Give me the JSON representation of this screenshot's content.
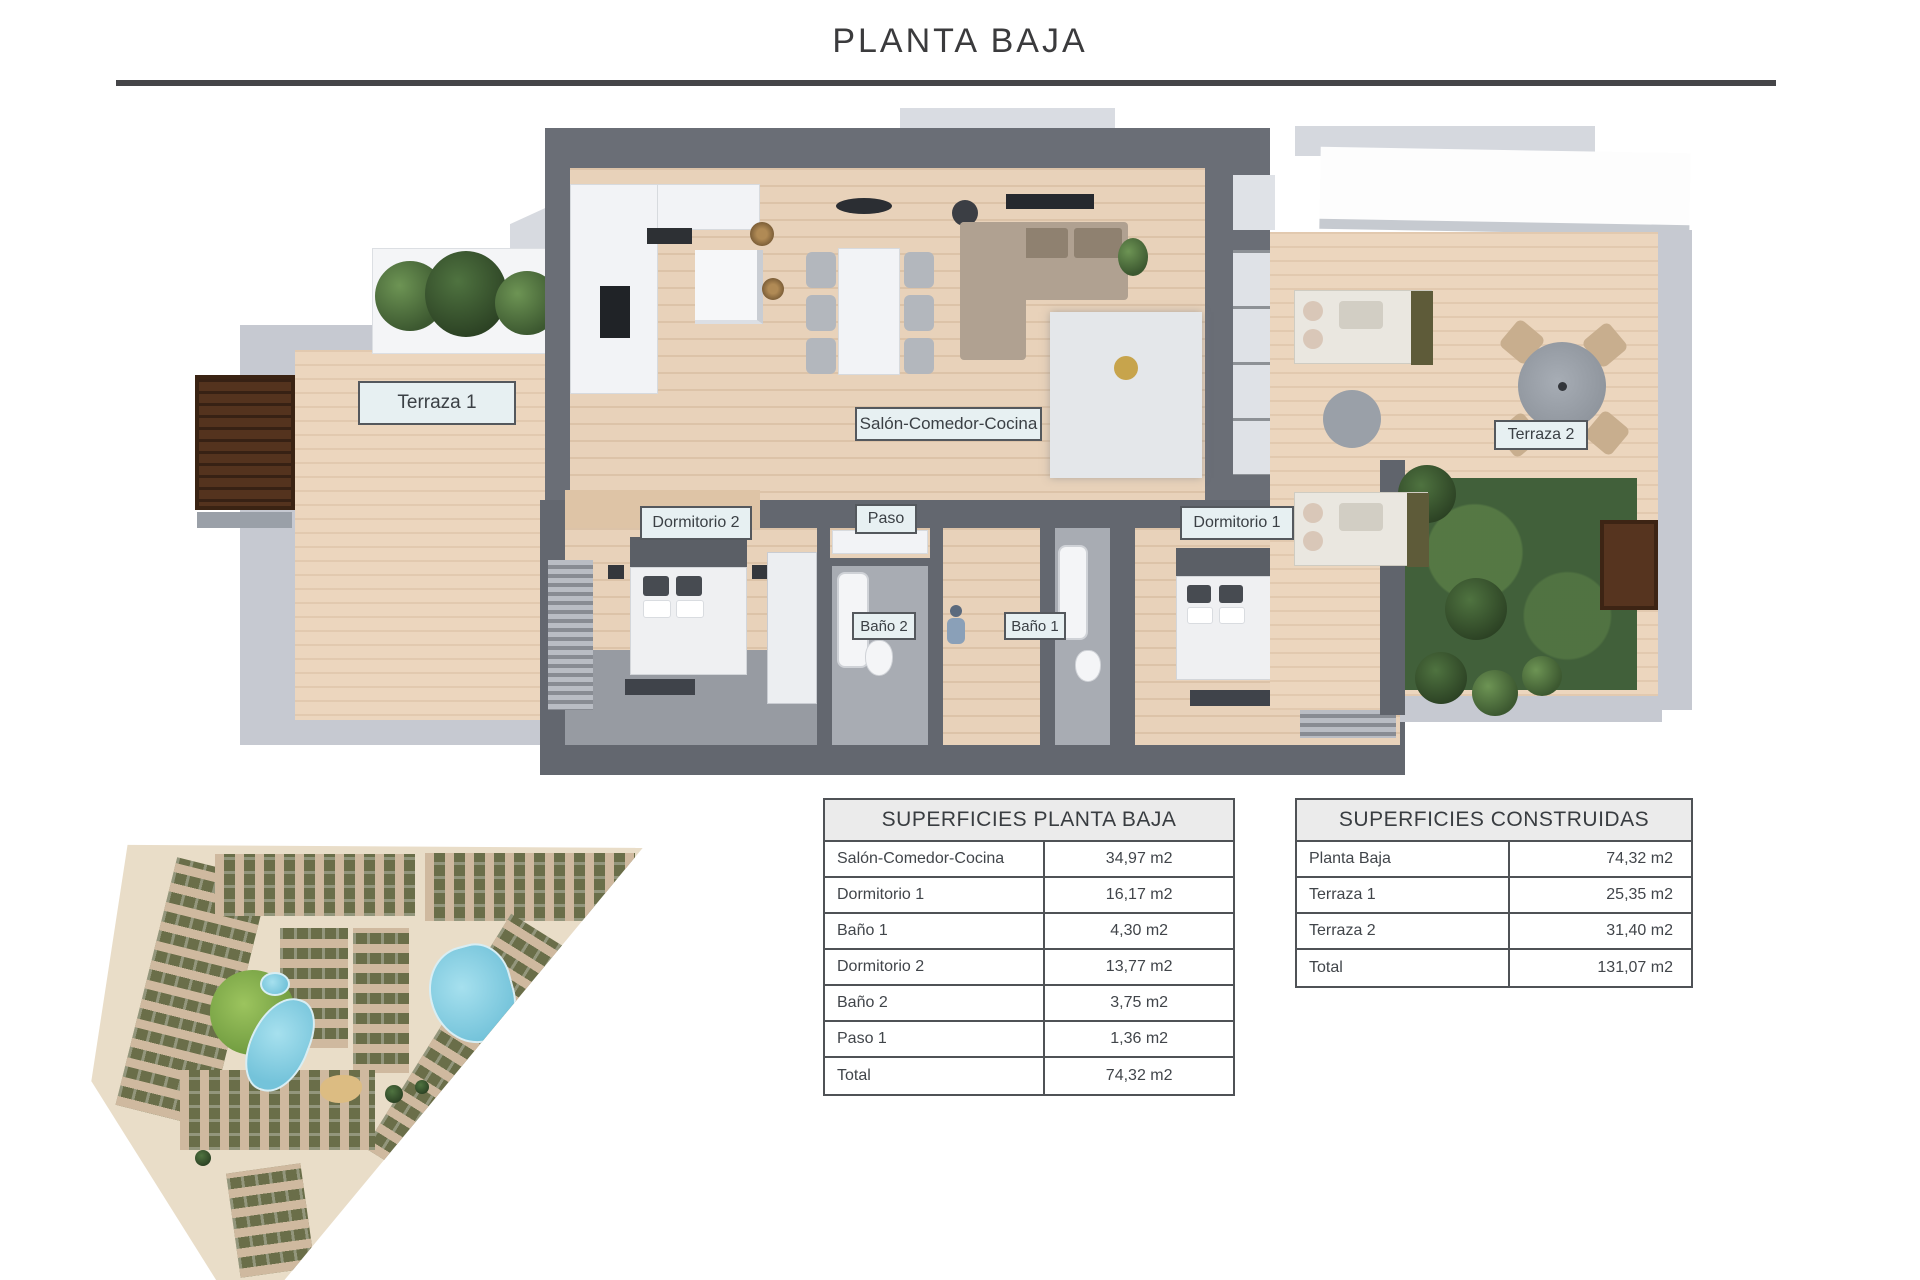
{
  "title": "PLANTA BAJA",
  "plan": {
    "labels": [
      {
        "id": "terraza-1",
        "text": "Terraza 1"
      },
      {
        "id": "salon-comedor-cocina",
        "text": "Salón-Comedor-Cocina"
      },
      {
        "id": "dormitorio-2",
        "text": "Dormitorio 2"
      },
      {
        "id": "paso",
        "text": "Paso"
      },
      {
        "id": "dormitorio-1",
        "text": "Dormitorio 1"
      },
      {
        "id": "bano-2",
        "text": "Baño 2"
      },
      {
        "id": "bano-1",
        "text": "Baño 1"
      },
      {
        "id": "terraza-2",
        "text": "Terraza 2"
      }
    ],
    "colors": {
      "wood_floor": "#e8d2ba",
      "dark_wall": "#6a6e76",
      "light_wall": "#c6c9d1",
      "bath_tile": "#a8acb3",
      "lawn": "#41603a",
      "label_background": "#e7f0f2",
      "pool_water": "#8ed2e4",
      "site_road": "#e9ddc8",
      "site_block": "#6a6e49"
    }
  },
  "tables": [
    {
      "title": "SUPERFICIES PLANTA BAJA",
      "rows": [
        {
          "name": "Salón-Comedor-Cocina",
          "area": "34,97 m2"
        },
        {
          "name": "Dormitorio 1",
          "area": "16,17 m2"
        },
        {
          "name": "Baño 1",
          "area": "4,30 m2"
        },
        {
          "name": "Dormitorio 2",
          "area": "13,77 m2"
        },
        {
          "name": "Baño 2",
          "area": "3,75 m2"
        },
        {
          "name": "Paso 1",
          "area": "1,36 m2"
        },
        {
          "name": "Total",
          "area": "74,32 m2"
        }
      ]
    },
    {
      "title": "SUPERFICIES CONSTRUIDAS",
      "rows": [
        {
          "name": "Planta Baja",
          "area": "74,32 m2"
        },
        {
          "name": "Terraza 1",
          "area": "25,35 m2"
        },
        {
          "name": "Terraza 2",
          "area": "31,40 m2"
        },
        {
          "name": "Total",
          "area": "131,07 m2"
        }
      ]
    }
  ]
}
